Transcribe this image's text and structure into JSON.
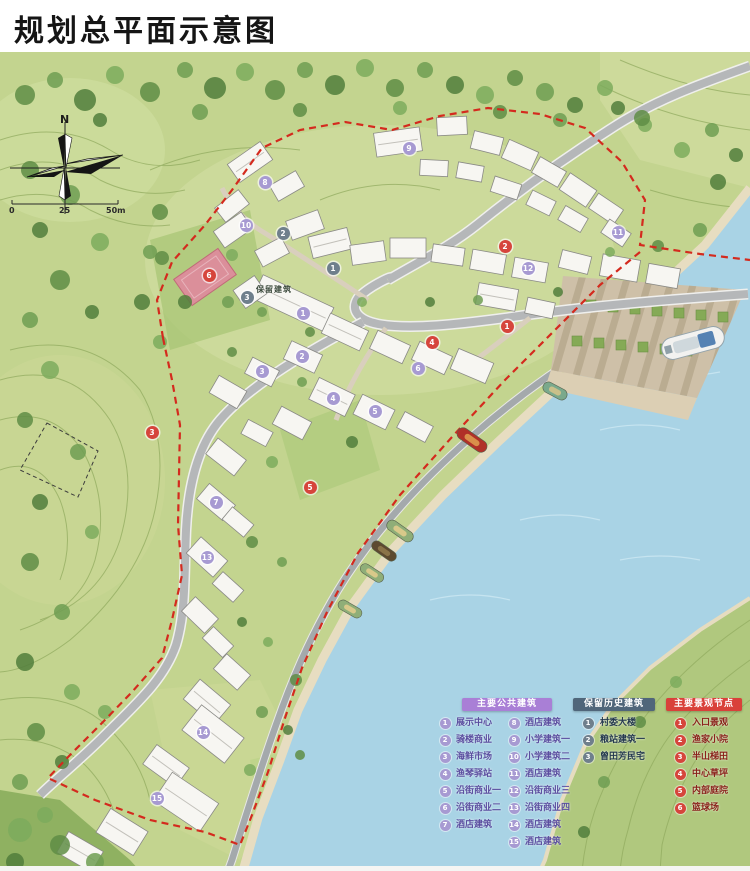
{
  "title": "规划总平面示意图",
  "compass": {
    "north": "N"
  },
  "scale_bar": {
    "labels": [
      "0",
      "25",
      "50m"
    ]
  },
  "map_labels": [
    {
      "text": "保留建筑"
    }
  ],
  "colors": {
    "boundary": "#d42a1e",
    "water": "#a9d3e5",
    "hill": "#c3d48f",
    "road": "#b5b7b9",
    "public_marker": "#a79ad2",
    "historical_marker": "#6f7f8c",
    "landscape_marker": "#d6453c"
  },
  "legend": {
    "sections": [
      {
        "id": "public",
        "title": "主要公共建筑",
        "header_bg": "#a97fd6",
        "header_text": "#ffffff",
        "circle": "#a79ad2",
        "text_color": "#5b4ea0",
        "columns": [
          [
            {
              "n": "1",
              "label": "展示中心"
            },
            {
              "n": "2",
              "label": "骑楼商业"
            },
            {
              "n": "3",
              "label": "海鲜市场"
            },
            {
              "n": "4",
              "label": "渔琴驿站"
            },
            {
              "n": "5",
              "label": "沿街商业一"
            },
            {
              "n": "6",
              "label": "沿街商业二"
            },
            {
              "n": "7",
              "label": "酒店建筑"
            }
          ],
          [
            {
              "n": "8",
              "label": "酒店建筑"
            },
            {
              "n": "9",
              "label": "小学建筑一"
            },
            {
              "n": "10",
              "label": "小学建筑二"
            },
            {
              "n": "11",
              "label": "酒店建筑"
            },
            {
              "n": "12",
              "label": "沿街商业三"
            },
            {
              "n": "13",
              "label": "沿街商业四"
            },
            {
              "n": "14",
              "label": "酒店建筑"
            },
            {
              "n": "15",
              "label": "酒店建筑"
            }
          ]
        ]
      },
      {
        "id": "historical",
        "title": "保留历史建筑",
        "header_bg": "#50667a",
        "header_text": "#ffffff",
        "circle": "#6f7f8c",
        "text_color": "#24394e",
        "columns": [
          [
            {
              "n": "1",
              "label": "村委大楼"
            },
            {
              "n": "2",
              "label": "粮站建筑一"
            },
            {
              "n": "3",
              "label": "曾田芳民宅"
            }
          ]
        ]
      },
      {
        "id": "landscape",
        "title": "主要景观节点",
        "header_bg": "#d9413a",
        "header_text": "#ffffff",
        "circle": "#d6453c",
        "text_color": "#8a221a",
        "columns": [
          [
            {
              "n": "1",
              "label": "入口景观"
            },
            {
              "n": "2",
              "label": "渔家小院"
            },
            {
              "n": "3",
              "label": "半山梯田"
            },
            {
              "n": "4",
              "label": "中心草坪"
            },
            {
              "n": "5",
              "label": "内部庭院"
            },
            {
              "n": "6",
              "label": "篮球场"
            }
          ]
        ]
      }
    ]
  },
  "markers": {
    "public": [
      {
        "n": "1",
        "x": 303,
        "y": 313
      },
      {
        "n": "2",
        "x": 302,
        "y": 356
      },
      {
        "n": "3",
        "x": 262,
        "y": 371
      },
      {
        "n": "4",
        "x": 333,
        "y": 398
      },
      {
        "n": "5",
        "x": 375,
        "y": 411
      },
      {
        "n": "6",
        "x": 418,
        "y": 368
      },
      {
        "n": "7",
        "x": 216,
        "y": 502
      },
      {
        "n": "8",
        "x": 265,
        "y": 182
      },
      {
        "n": "9",
        "x": 409,
        "y": 148
      },
      {
        "n": "10",
        "x": 246,
        "y": 225
      },
      {
        "n": "11",
        "x": 618,
        "y": 232
      },
      {
        "n": "12",
        "x": 528,
        "y": 268
      },
      {
        "n": "13",
        "x": 207,
        "y": 557
      },
      {
        "n": "14",
        "x": 203,
        "y": 732
      },
      {
        "n": "15",
        "x": 157,
        "y": 798
      }
    ],
    "historical": [
      {
        "n": "1",
        "x": 333,
        "y": 268
      },
      {
        "n": "2",
        "x": 283,
        "y": 233
      },
      {
        "n": "3",
        "x": 247,
        "y": 297
      }
    ],
    "landscape": [
      {
        "n": "1",
        "x": 507,
        "y": 326
      },
      {
        "n": "2",
        "x": 505,
        "y": 246
      },
      {
        "n": "3",
        "x": 152,
        "y": 432
      },
      {
        "n": "4",
        "x": 432,
        "y": 342
      },
      {
        "n": "5",
        "x": 310,
        "y": 487
      },
      {
        "n": "6",
        "x": 209,
        "y": 275
      }
    ]
  }
}
